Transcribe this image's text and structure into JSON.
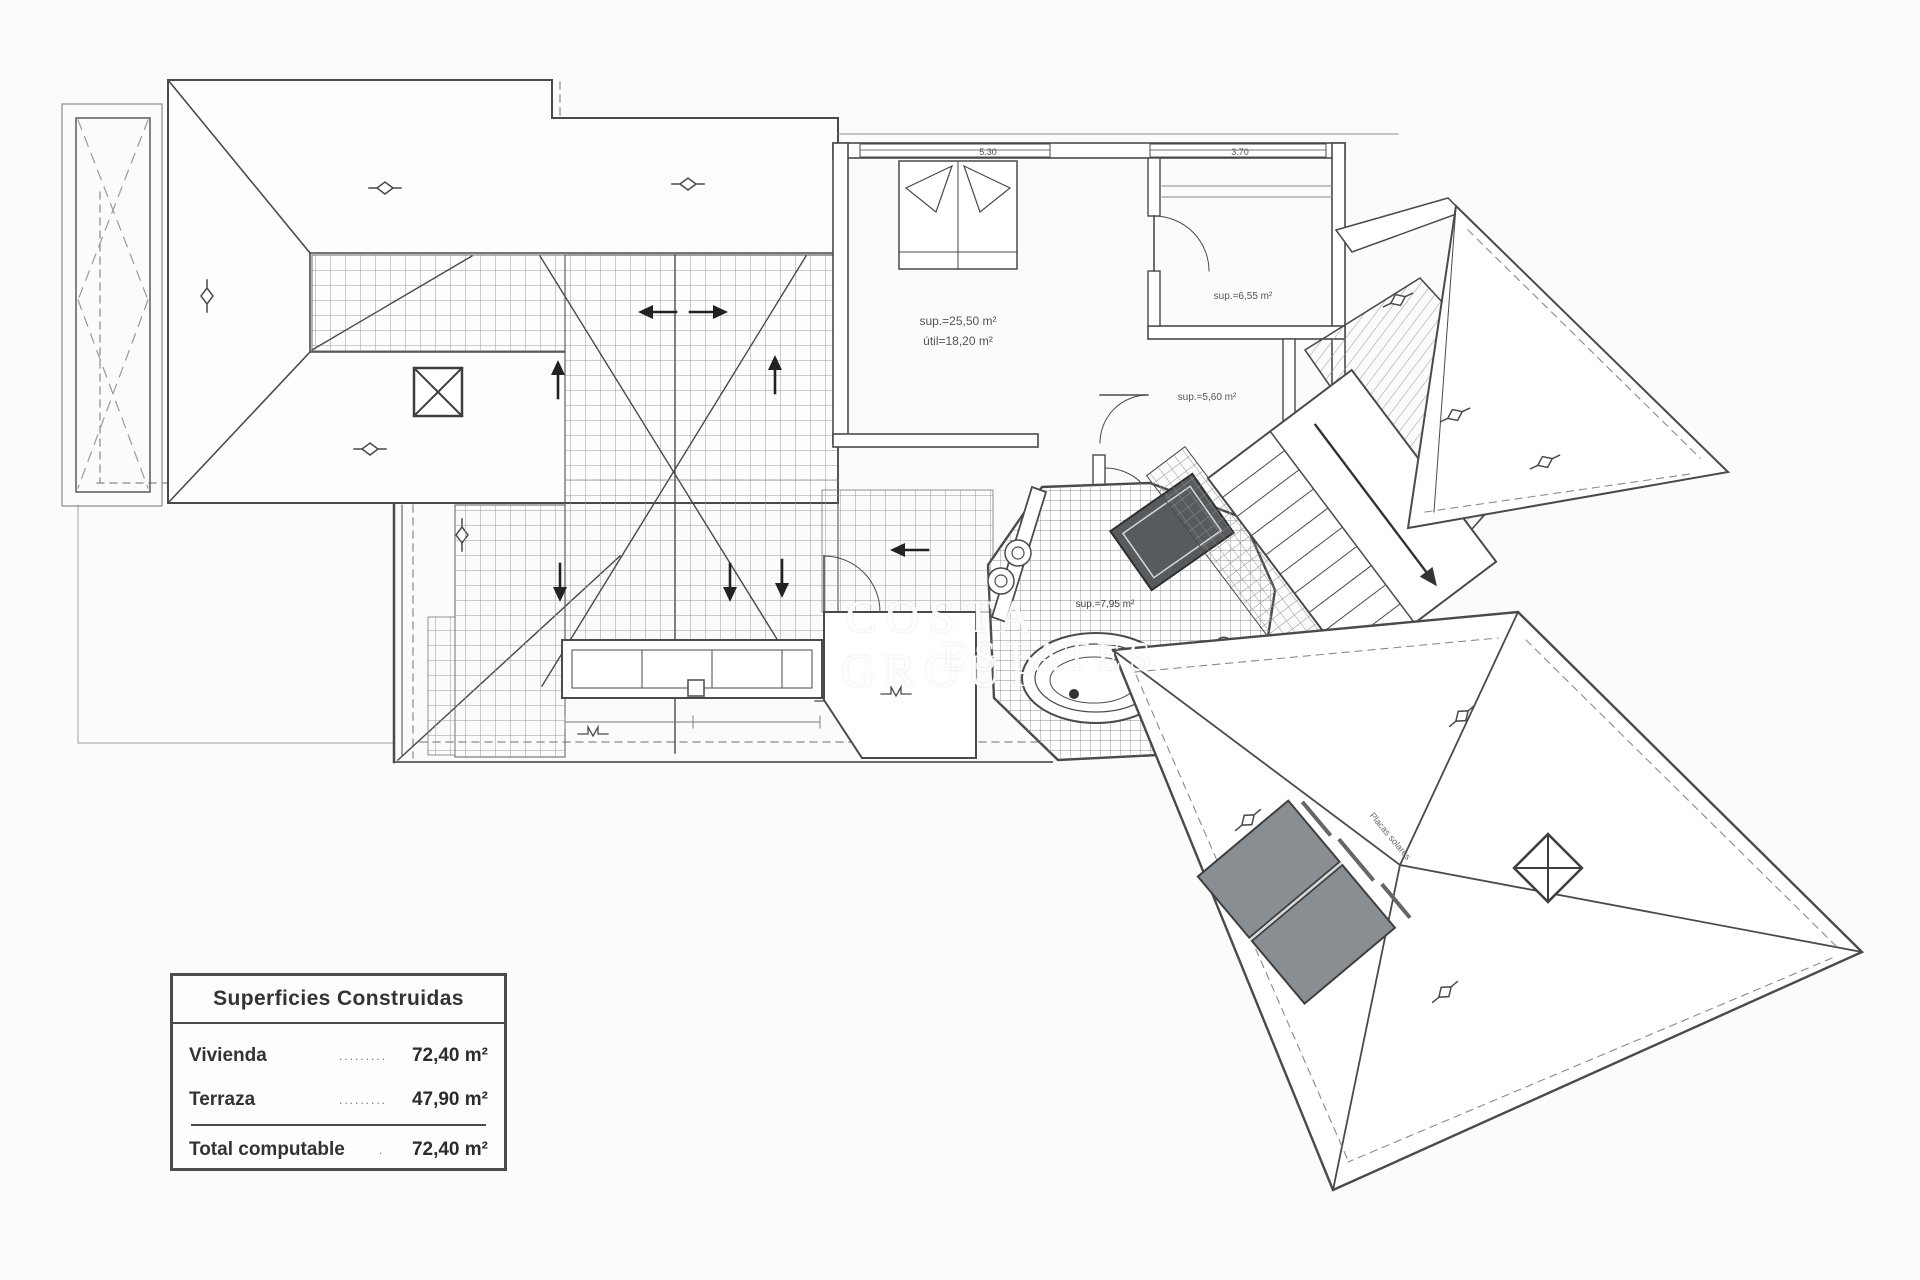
{
  "legend": {
    "title": "Superficies Construidas",
    "rows": [
      {
        "label": "Vivienda",
        "dots": "...............",
        "value": "72,40 m²"
      },
      {
        "label": "Terraza",
        "dots": "...............",
        "value": "47,90 m²"
      }
    ],
    "total": {
      "label": "Total computable",
      "dots": "......",
      "value": "72,40 m²"
    }
  },
  "watermark": {
    "line1": "COSTA GROUP",
    "line2": "ESTATES"
  },
  "plan": {
    "labels": {
      "bedroom_sup": "sup.=25,50 m²",
      "bedroom_util": "útil=18,20 m²",
      "dressing_sup": "sup.=6,55 m²",
      "hall_sup": "sup.=5,60 m²",
      "bath_sup": "sup.=7,95 m²",
      "solar": "Placas solares"
    },
    "dimensions": {
      "bedroom_width": "5.30",
      "dressing_width": "3.70"
    },
    "colors": {
      "line": "#4a4a4a",
      "line_light": "#8c8c8c",
      "hatch": "#9a9a9a",
      "solar_panel": "#898e92",
      "dark_fixture": "#575b5e"
    }
  }
}
